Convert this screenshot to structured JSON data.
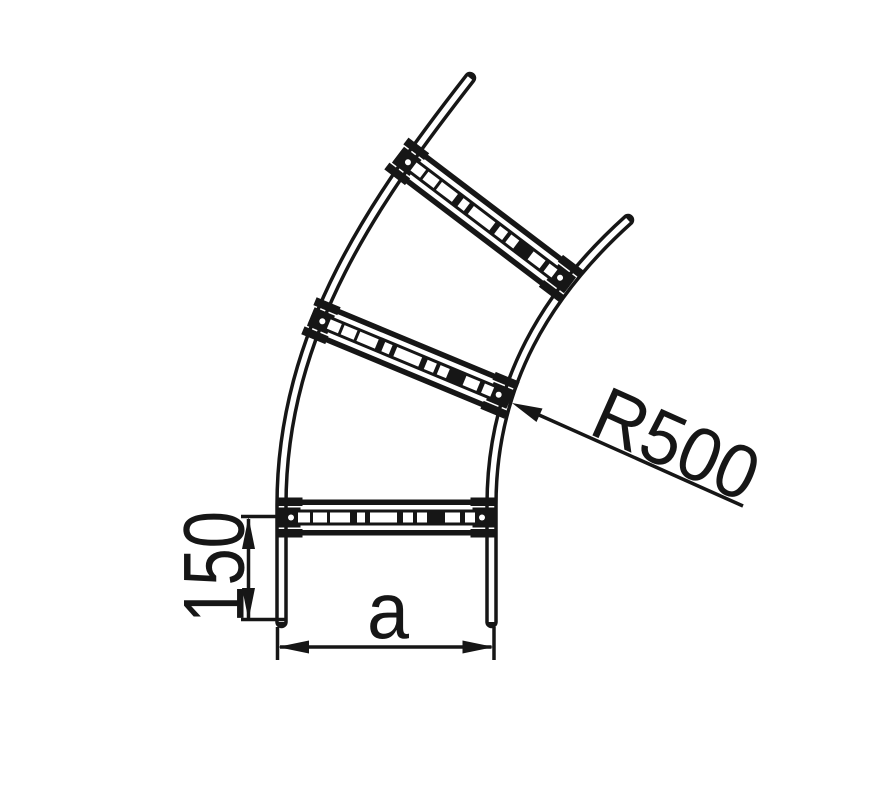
{
  "drawing": {
    "subject": "curved cable ladder bend, dimensioned technical line drawing",
    "labels": {
      "radius": "R500",
      "straight_end_length": "150",
      "width": "a"
    },
    "colors": {
      "line": "#161616",
      "background": "#ffffff"
    }
  }
}
